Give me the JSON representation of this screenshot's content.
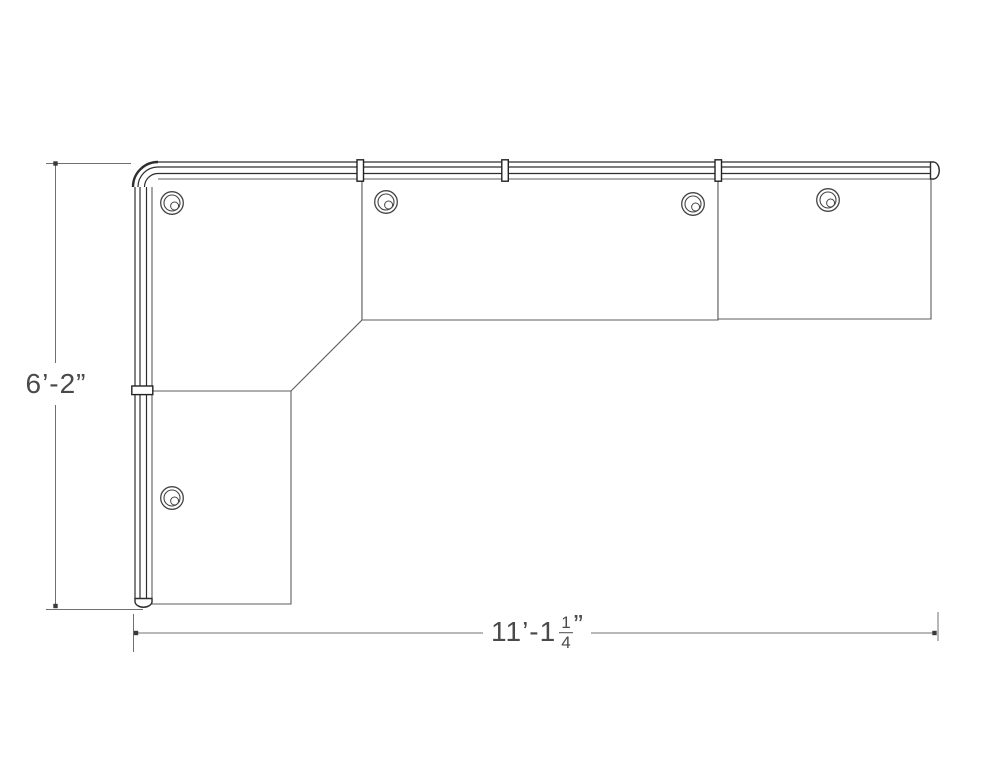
{
  "drawing": {
    "width": 1000,
    "height": 773,
    "background": "#ffffff",
    "colors": {
      "surface_line": "#5c5c5c",
      "rail_line": "#2e2e2e",
      "connector_line": "#222222",
      "grommet_line": "#454545",
      "dim_line": "#707070",
      "dim_tick": "#3a3a3a",
      "text": "#4a4a4a"
    },
    "surfaces": [
      {
        "name": "corner-worksurface",
        "points": "152,179 362,179 362,320 291,391 152,391"
      },
      {
        "name": "middle-worksurface",
        "points": "362,179 718,179 718,320 362,320"
      },
      {
        "name": "right-worksurface",
        "points": "718,179 931,179 931,319 718,319"
      },
      {
        "name": "return-worksurface",
        "points": "152,391 291,391 291,604 152,604"
      }
    ],
    "rail_lines": [
      {
        "x1": 158,
        "y1": 162,
        "x2": 930.5,
        "y2": 162
      },
      {
        "x1": 158,
        "y1": 167,
        "x2": 930.5,
        "y2": 167
      },
      {
        "x1": 158,
        "y1": 173.5,
        "x2": 930.5,
        "y2": 173.5
      },
      {
        "x1": 135,
        "y1": 187,
        "x2": 135,
        "y2": 598.5
      },
      {
        "x1": 140,
        "y1": 187,
        "x2": 140,
        "y2": 598.5
      },
      {
        "x1": 146.5,
        "y1": 187,
        "x2": 146.5,
        "y2": 598.5
      }
    ],
    "paths": [
      {
        "name": "corner-elbow-fill",
        "d": "M 158 162 A 25 25 0 0 0 133 187 L 158 187 Z",
        "fill": "#ffffff",
        "stroke": "none",
        "w": 0
      },
      {
        "name": "corner-elbow-outer-arc",
        "d": "M 158 162 A 25 25 0 0 0 133 187",
        "w": 2.4
      },
      {
        "name": "corner-elbow-mid-arc",
        "d": "M 158 167 A 20 20 0 0 0 138 187",
        "w": 1.2
      },
      {
        "name": "corner-elbow-inner-arc",
        "d": "M 158 173.5 A 13.5 13.5 0 0 0 144.5 187",
        "w": 1.2
      },
      {
        "name": "rail-end-cap-right",
        "d": "M 930.5 162 L 934 162 A 6.2 8.6 0 0 1 934 179 L 930.5 179 Z",
        "fill": "#ffffff",
        "w": 1.4
      },
      {
        "name": "rail-end-cap-bottom",
        "d": "M 135 598.5 L 135 602 A 8.6 6.2 0 0 0 152 602 L 152 598.5 Z",
        "fill": "#ffffff",
        "w": 1.4
      }
    ],
    "connectors": [
      {
        "x": 357,
        "y": 159.8,
        "w": 6.5,
        "h": 21.4
      },
      {
        "x": 501.8,
        "y": 159.8,
        "w": 6.5,
        "h": 21.4
      },
      {
        "x": 715,
        "y": 159.8,
        "w": 6.5,
        "h": 21.4
      },
      {
        "x": 131.8,
        "y": 386,
        "w": 21,
        "h": 8.6
      }
    ],
    "grommets": [
      {
        "cx": 172,
        "cy": 203
      },
      {
        "cx": 386,
        "cy": 202
      },
      {
        "cx": 693,
        "cy": 204
      },
      {
        "cx": 828,
        "cy": 200
      },
      {
        "cx": 172,
        "cy": 498
      }
    ],
    "dim_lines": [
      {
        "name": "height-dim-line",
        "x1": 55.5,
        "y1": 163.5,
        "x2": 55.5,
        "y2": 606
      },
      {
        "name": "height-ext-line-top",
        "x1": 46,
        "y1": 163.5,
        "x2": 131,
        "y2": 163.5
      },
      {
        "name": "height-ext-line-bottom",
        "x1": 46,
        "y1": 609.5,
        "x2": 143,
        "y2": 609.5
      },
      {
        "name": "width-dim-line",
        "x1": 136,
        "y1": 633,
        "x2": 936,
        "y2": 633
      },
      {
        "name": "width-ext-line-left",
        "x1": 133.5,
        "y1": 614,
        "x2": 133.5,
        "y2": 652
      },
      {
        "name": "width-ext-line-right",
        "x1": 938,
        "y1": 612,
        "x2": 938,
        "y2": 641
      }
    ],
    "dim_ticks": [
      {
        "x": 55.5,
        "y": 163.5
      },
      {
        "x": 55.5,
        "y": 606
      },
      {
        "x": 136,
        "y": 633
      },
      {
        "x": 934.5,
        "y": 633
      }
    ],
    "labels": {
      "vertical": {
        "text": "6’-2”",
        "cx": 56,
        "cy": 384
      },
      "horizontal": {
        "whole": "11’-1",
        "numerator": "1",
        "denominator": "4",
        "suffix": "”",
        "cx": 537,
        "cy": 632
      }
    }
  }
}
